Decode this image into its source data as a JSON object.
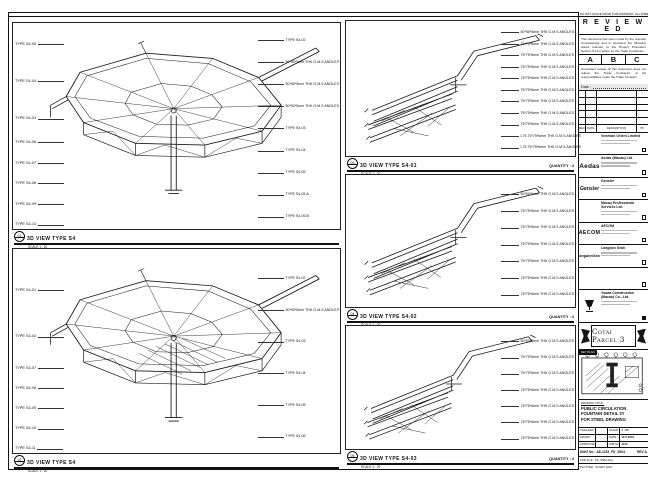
{
  "sheet": {
    "frame_note": "DO NOT SCALE FROM THIS DRAWING. ALL DIMENSIONS TO BE CHECKED ON SITE. ALL DIMENSIONS IN MM."
  },
  "panels": {
    "left_top": {
      "bubble": "01",
      "title": "3D VIEW TYPE S4",
      "scale": "SCALE 1 : 20",
      "left_labels": [
        "TYPE S4-05",
        "TYPE S4-04",
        "TYPE S4-03"
      ],
      "mast_labels": [
        "TYPE S4-06",
        "TYPE S4-07",
        "TYPE S4-08",
        "TYPE S4-09",
        "TYPE S4-10"
      ],
      "right_labels": [
        "TYPE S4-02",
        "50*50*5mm THK G.M.S ANGLES",
        "50*50*5mm THK G.M.S ANGLES",
        "50*50*5mm THK G.M.S ANGLES",
        "TYPE S4-03",
        "TYPE S4-04",
        "TYPE S4-05",
        "TYPE S4-05.A",
        "TYPE S4-05.B"
      ]
    },
    "left_bottom": {
      "bubble": "02",
      "title": "3D VIEW TYPE S4",
      "scale": "SCALE 1 : 20",
      "left_labels": [
        "TYPE S4-01",
        "TYPE S4-02"
      ],
      "mast_labels": [
        "TYPE S4-07",
        "TYPE S4-08",
        "TYPE S4-09",
        "TYPE S4-10",
        "TYPE S4-11"
      ],
      "right_labels": [
        "TYPE S4-02",
        "50*50*5mm THK G.M.S ANGLES",
        "TYPE S4-03",
        "TYPE S4-04",
        "TYPE S4-05",
        "TYPE S4-06"
      ]
    },
    "mid": [
      {
        "bubble": "03",
        "title": "3D VIEW TYPE S4-01",
        "quantity": "QUANTITY : 4",
        "scale": "SCALE 1 : 20",
        "labels": [
          "50*50*5mm THK G.M.S ANGLES",
          "75*75*6mm THK G.M.S ANGLES",
          "75*75*6mm THK G.M.S ANGLES",
          "75*75*6mm THK G.M.S ANGLES",
          "75*75*6mm THK G.M.S ANGLES",
          "75*75*6mm THK G.M.S ANGLES",
          "75*75*6mm THK G.M.S ANGLES",
          "75*75*6mm THK G.M.S ANGLES",
          "75*75*6mm THK G.M.S ANGLES",
          "L75 75*75*6mm THK G.M.S ANGLES",
          "L75 75*75*6mm THK G.M.S ANGLES"
        ]
      },
      {
        "bubble": "04",
        "title": "3D VIEW TYPE S4-02",
        "quantity": "QUANTITY : 4",
        "scale": "SCALE 1 : 20",
        "labels": [
          "50*50*5mm THK G.M.S ANGLES",
          "75*75*6mm THK G.M.S ANGLES",
          "75*75*6mm THK G.M.S ANGLES",
          "75*75*6mm THK G.M.S ANGLES",
          "75*75*6mm THK G.M.S ANGLES",
          "75*75*6mm THK G.M.S ANGLES",
          "75*75*6mm THK G.M.S ANGLES"
        ]
      },
      {
        "bubble": "05",
        "title": "3D VIEW TYPE S4-03",
        "quantity": "QUANTITY : 4",
        "scale": "SCALE 1 : 20",
        "labels": [
          "50*50*5mm THK G.M.S ANGLES",
          "75*75*6mm THK G.M.S ANGLES",
          "75*75*6mm THK G.M.S ANGLES",
          "75*75*6mm THK G.M.S ANGLES",
          "75*75*6mm THK G.M.S ANGLES",
          "75*75*6mm THK G.M.S ANGLES",
          "75*75*6mm THK G.M.S ANGLES"
        ]
      }
    ]
  },
  "titleblock": {
    "reviewed": {
      "title": "R E V I E W E D",
      "para1": "This document has been noted by the relevant Consultant(s) and is accorded the following status relevant to the Project Procedure Section 5.4 for action by the Trade Contractor.",
      "grades": [
        "A",
        "B",
        "C"
      ],
      "para2": "Consultant review of this document does not relieve the Trade Contractor of his responsibilities under the Trade Contract.",
      "date_label": "Date :"
    },
    "revision": {
      "blank": [
        "",
        "",
        "",
        "",
        ""
      ],
      "header": [
        "REV",
        "DATE",
        "DESCRIPTION",
        "BY"
      ]
    },
    "consultants": [
      {
        "logo": "",
        "logo_class": "lg-venetian",
        "row_class": "cons-norm",
        "name": "Venetian Orient Limited"
      },
      {
        "logo": "Aedas",
        "logo_class": "lg-aedas",
        "row_class": "cons-norm",
        "name": "Aedas (Macau) Ltd."
      },
      {
        "logo": "Gensler",
        "logo_class": "lg-gensler",
        "row_class": "cons-norm",
        "name": "Gensler"
      },
      {
        "logo": "",
        "logo_class": "lg-mps",
        "row_class": "cons-norm",
        "name": "Macau Professional Services Ltd."
      },
      {
        "logo": "AECOM",
        "logo_class": "lg-aecom",
        "row_class": "cons-norm",
        "name": "AECOM"
      },
      {
        "logo": "LangdonSeah",
        "logo_class": "lg-ls",
        "row_class": "cons-norm",
        "name": "Langdon Seah"
      },
      {
        "logo": "",
        "logo_class": "lg-none",
        "row_class": "cons-empty",
        "name": ""
      }
    ],
    "contractor": {
      "name": "Yuada Construction (Macau) Co., Ltd."
    },
    "banner": "Cotai Parcel 3",
    "keyplan_label": "KEY PLAN",
    "drawing_title": {
      "label": "DRAWING TITLE :",
      "lines": [
        "PUBLIC CIRCULATION",
        "FOUNTAIN DETAIL 3Y",
        "FOR STEEL DRAWING"
      ]
    },
    "info": {
      "rows": [
        {
          "k1": "CHECKED",
          "v1": "-",
          "k2": "SCALE",
          "v2": "1 : 20"
        },
        {
          "k1": "DRAWN",
          "v1": "-",
          "k2": "DATE",
          "v2": "10-5-2010"
        },
        {
          "k1": "APPROVED",
          "v1": "-",
          "k2": "JOB No",
          "v2": "1153"
        }
      ],
      "dwg_label": "DWG No :",
      "dwg_no": "AE-1153_FD_S504",
      "rev": "REV A",
      "file_line": "CAD FILE : FD_S504.dwg",
      "plot_line": "PLOTTED : 10 MAY 2010"
    }
  }
}
